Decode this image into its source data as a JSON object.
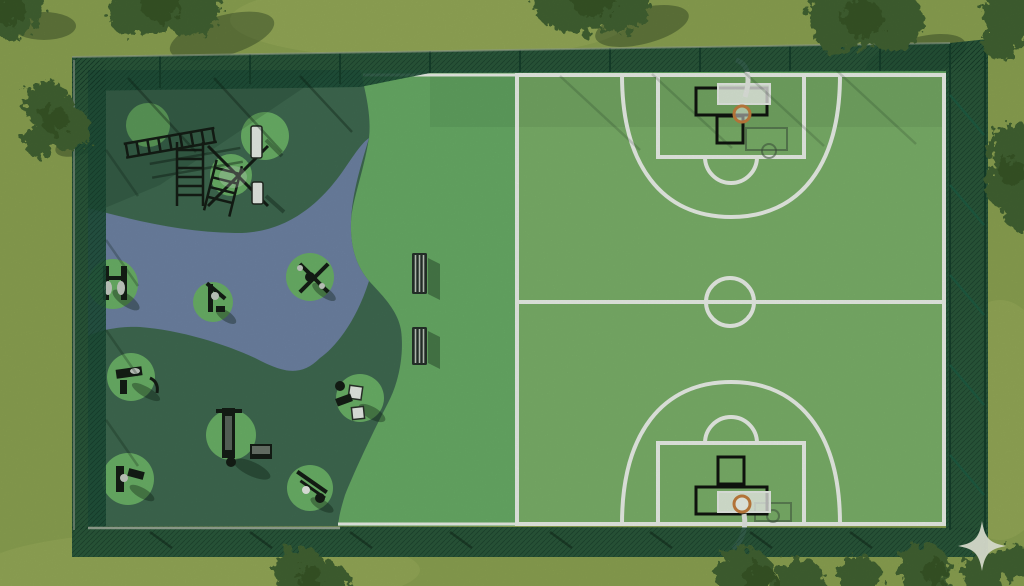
{
  "scene": {
    "description": "Aerial 3D render of a fenced outdoor sports facility: calisthenics and outdoor-gym zone with winding rubber path on the left, turf strip with park benches in the middle, full basketball court on the right, lawn and trees around",
    "areas": {
      "fitness_zone": "outdoor gym on dark rubber surface",
      "walking_path": "blue-grey winding path",
      "turf_strip": "green turf with benches",
      "basketball_court": "green court with white markings"
    },
    "inventory": {
      "fitness_pads": 11,
      "park_benches": 2,
      "basketball_hoops": 2,
      "calisthenics_rig": 1,
      "perimeter_fence": 1,
      "sparkle_watermark": 1
    }
  },
  "colors": {
    "grass": "#8da452",
    "grass_light": "#9eb15e",
    "turf": "#69ae67",
    "court": "#7cb26a",
    "rubber_dark": "#3f6b51",
    "path_blue": "#6f84a5",
    "pad_green": "#6cb368",
    "fence_mesh": "#1d4f38",
    "fence_rail": "#16402c",
    "line_white": "#eef3ec",
    "board_white": "#e9efe8",
    "hoop_orange": "#c57f3e",
    "equipment_dark": "#141d15",
    "metal_gray": "#c7cfc6",
    "bench_dark": "#26312a",
    "bench_slat": "#bdc7bb",
    "tree_canopy": "#436331",
    "tree_dark": "#2f4d21",
    "curb_gray": "#b3bbac",
    "sparkle": "#e9eedd"
  }
}
